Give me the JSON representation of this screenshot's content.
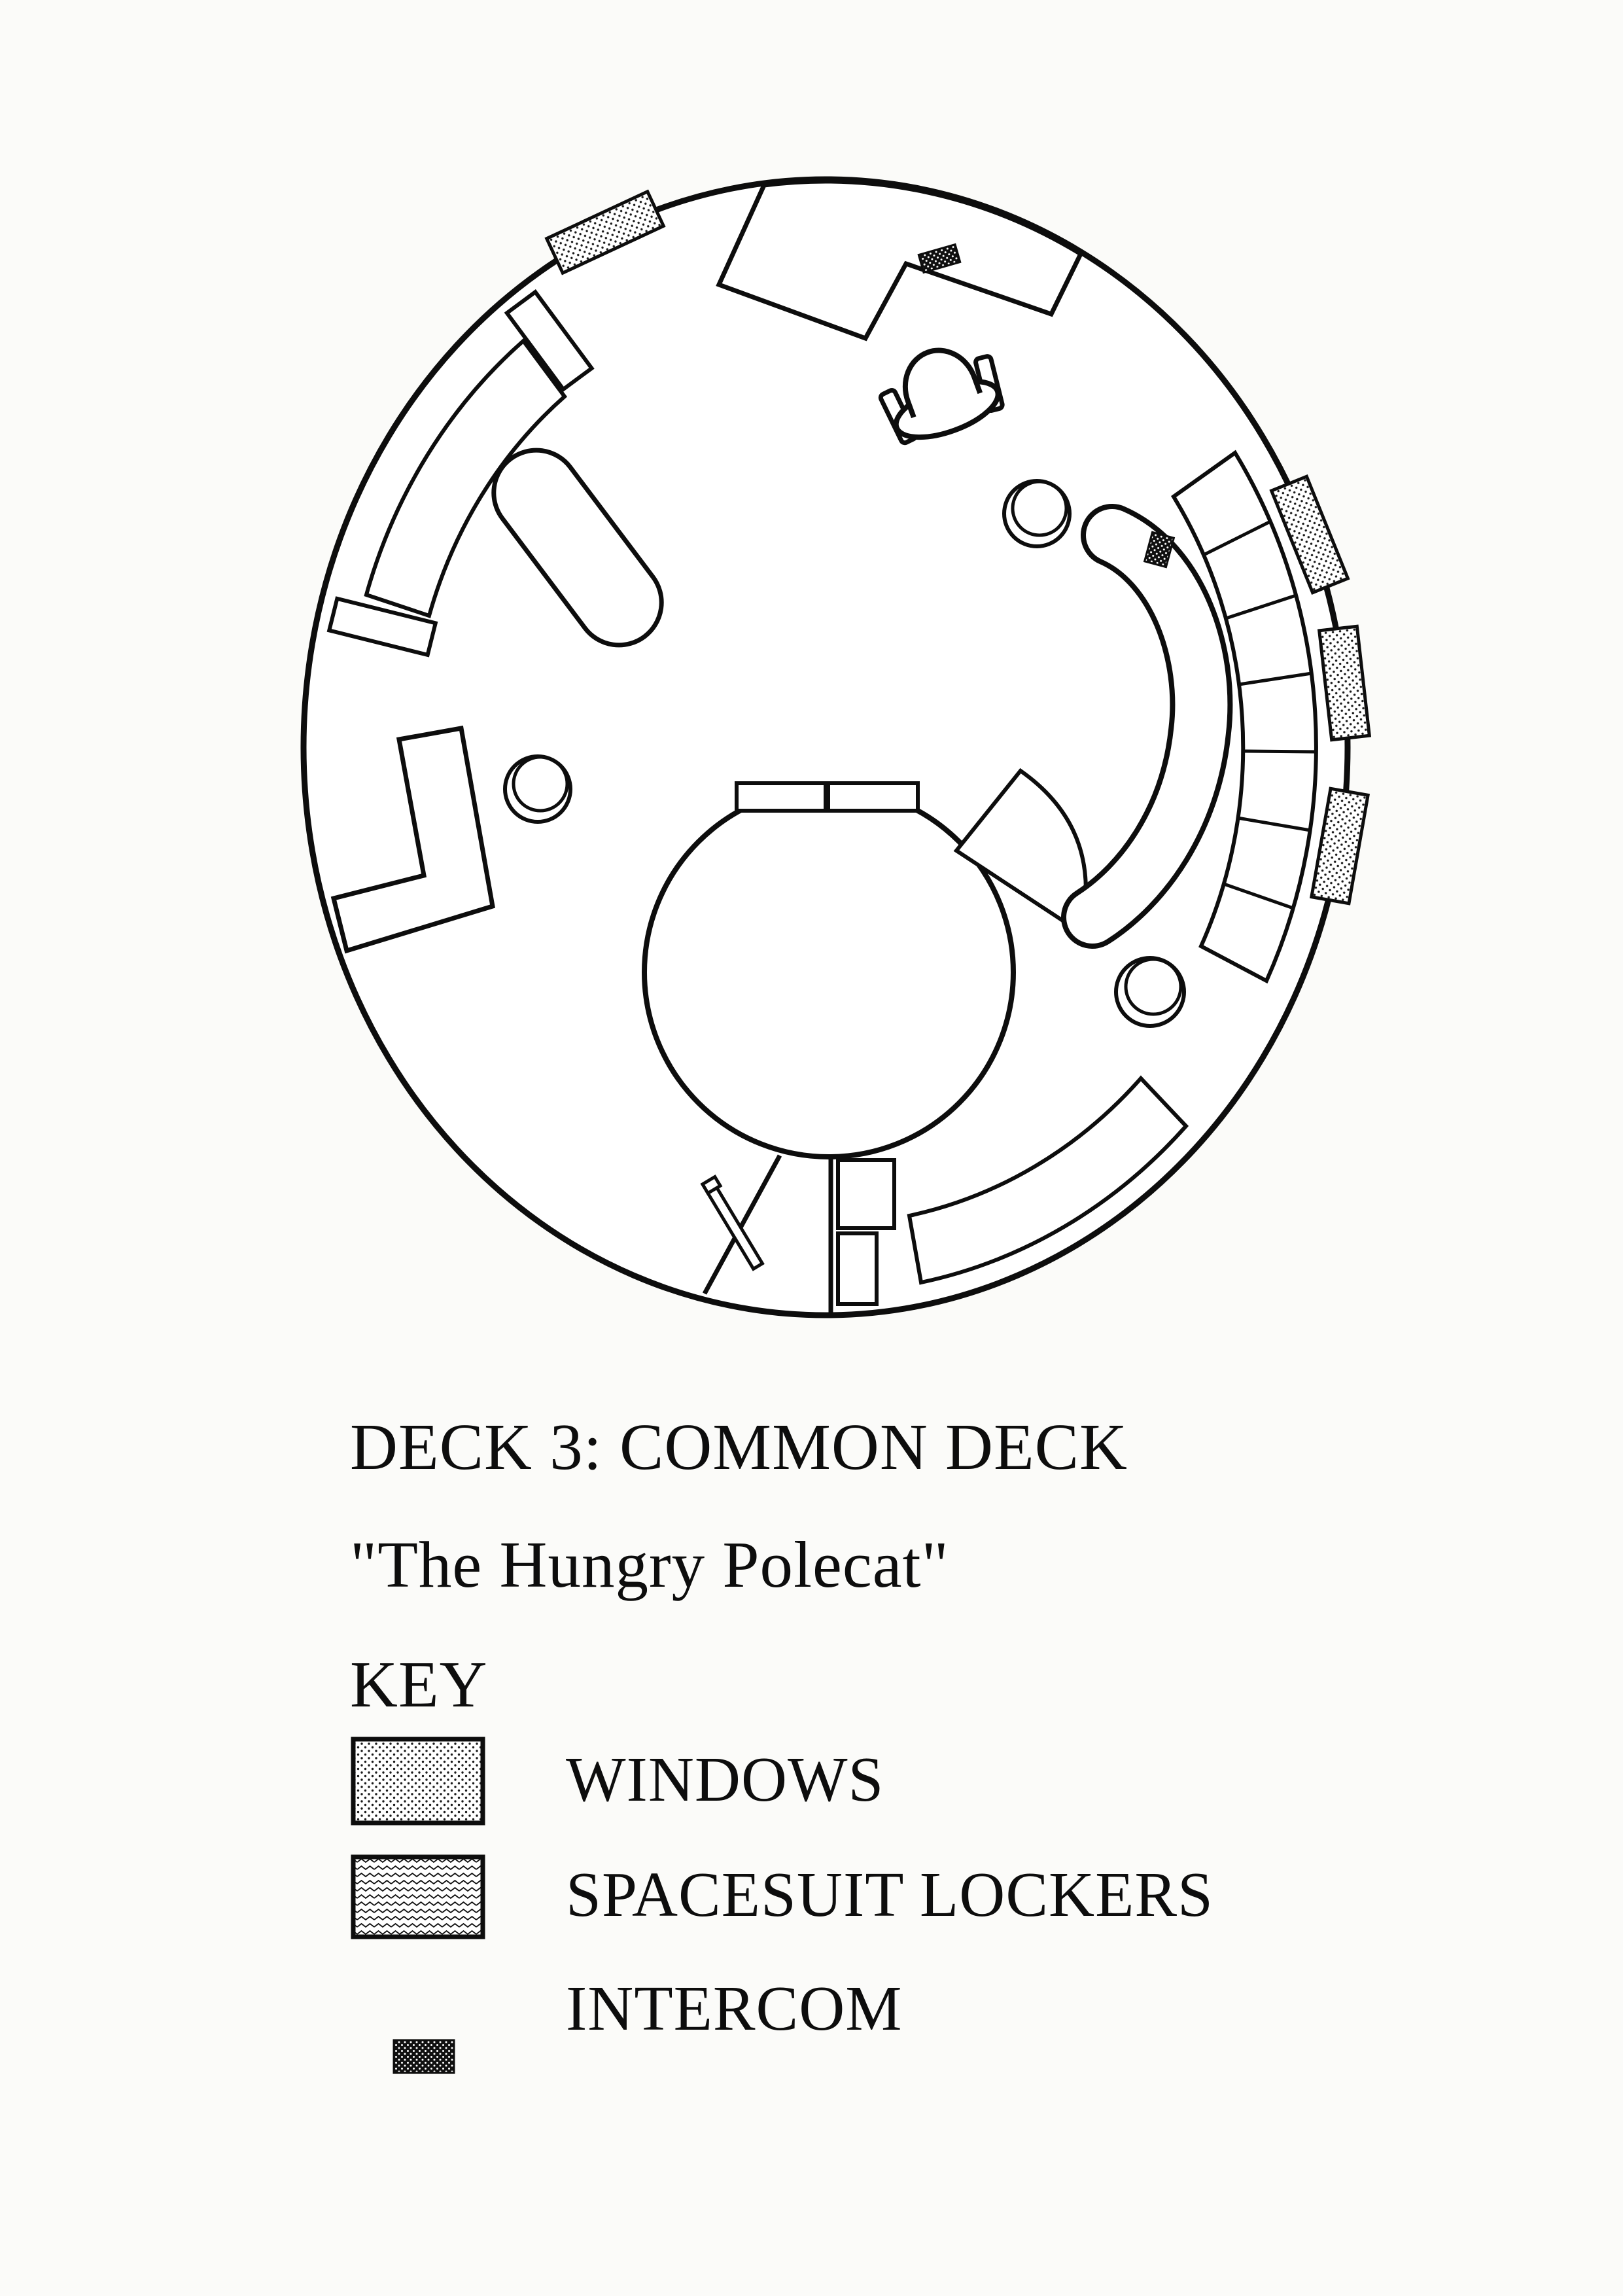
{
  "page": {
    "kind": "scanned deck plan page",
    "paper_color": "#fbfbf9",
    "ink_color": "#0d0d0d"
  },
  "plan": {
    "deck_title": "DECK 3: COMMON DECK",
    "deck_name": "\"The Hungry Polecat\"",
    "features": [
      "circular-deck-outline",
      "bar-counter",
      "chair",
      "curved-wall-bench",
      "oval-table",
      "l-shaped-counter",
      "stools",
      "large-round-table",
      "table-side-counters",
      "seat-wedge",
      "partition-walls",
      "side-tables",
      "door-leaf",
      "curved-bench",
      "banana-bench",
      "spacesuit-locker-bank",
      "windows",
      "intercoms"
    ]
  },
  "key": {
    "heading": "KEY",
    "items": [
      {
        "symbol": "windows-swatch",
        "label": "WINDOWS"
      },
      {
        "symbol": "spacesuit-lockers-swatch",
        "label": "SPACESUIT LOCKERS"
      },
      {
        "symbol": "intercom-swatch",
        "label": "INTERCOM"
      }
    ]
  }
}
